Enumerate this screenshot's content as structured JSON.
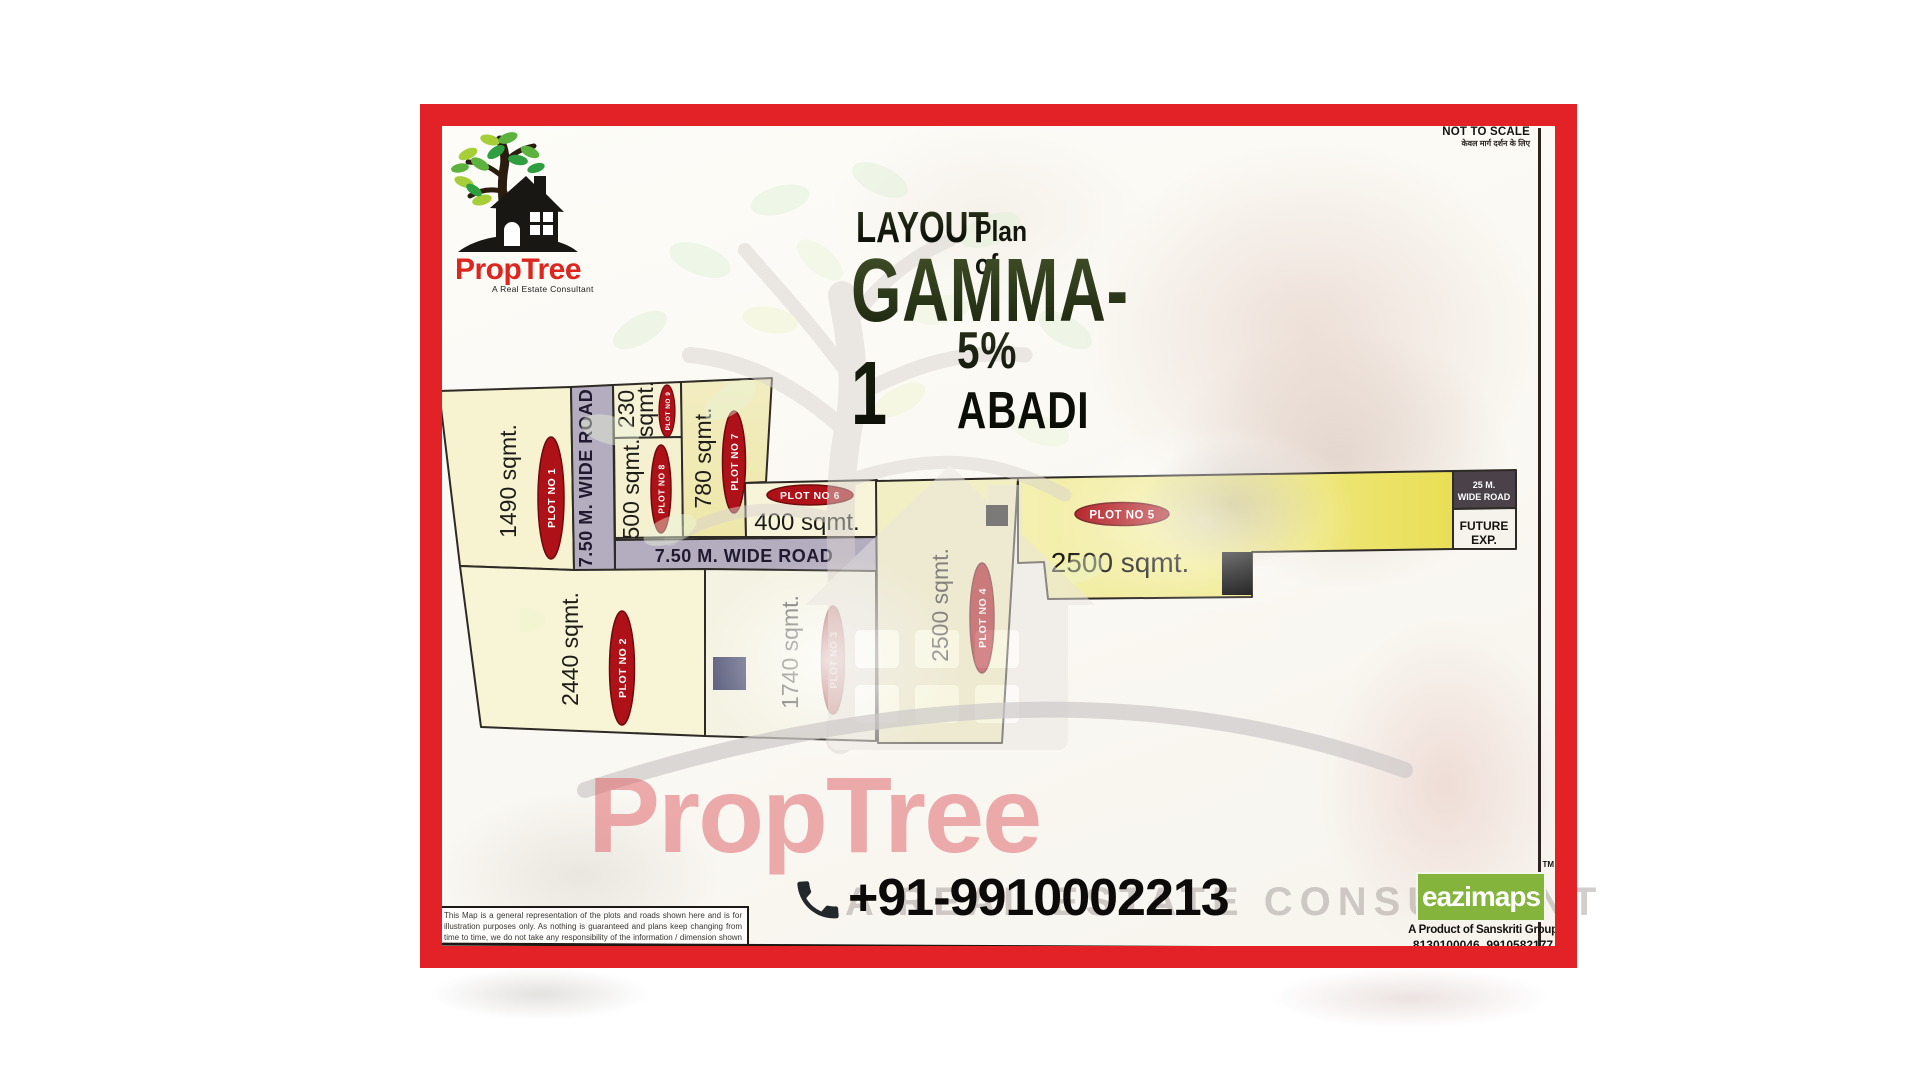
{
  "header": {
    "not_to_scale": "NOT TO SCALE",
    "not_to_scale_sub": "केवल मार्ग दर्शन के लिए"
  },
  "logo": {
    "brand": "PropTree",
    "tagline": "A Real Estate Consultant"
  },
  "title": {
    "prefix": "LAYOUT",
    "prefix_sub": "Plan of",
    "name": "GAMMA-1",
    "subtitle": "5% ABADI"
  },
  "map": {
    "roads": {
      "vertical": "7.50 M. WIDE ROAD",
      "horizontal": "7.50 M. WIDE ROAD",
      "wide_line1": "25 M.",
      "wide_line2": "WIDE ROAD",
      "future_line1": "FUTURE",
      "future_line2": "EXP."
    },
    "plots": [
      {
        "badge": "PLOT NO 1",
        "area": "1490 sqmt."
      },
      {
        "badge": "PLOT NO 2",
        "area": "2440 sqmt."
      },
      {
        "badge": "PLOT NO 3",
        "area": "1740 sqmt."
      },
      {
        "badge": "PLOT NO 4",
        "area": "2500 sqmt."
      },
      {
        "badge": "PLOT NO 5",
        "area": "2500 sqmt."
      },
      {
        "badge": "PLOT NO 6",
        "area": "400 sqmt."
      },
      {
        "badge": "PLOT NO 7",
        "area": "780 sqmt."
      },
      {
        "badge": "PLOT NO 8",
        "area": "500 sqmt."
      },
      {
        "badge": "PLOT NO 9",
        "area": "230 sqmt.",
        "area_lines": [
          "230",
          "sqmt."
        ]
      }
    ]
  },
  "watermark": {
    "brand": "PropTree",
    "tagline": "A Real Estate Consultant"
  },
  "contact": {
    "phone": "+91-9910002213"
  },
  "disclaimer": "This Map is a general representation of the plots and roads shown here and is for illustration purposes only. As nothing is guaranteed and plans keep changing from time to time, we do not take any responsibility of the information / dimension shown here. Hence, it is requested to kindly verify the details from the concerned authority and proceed with due diligence and decision.",
  "publisher": {
    "brand": "eazimaps",
    "tm": "TM",
    "line1": "A Product of Sanskriti Group",
    "line2": "8130100046, 9910582177"
  },
  "colors": {
    "frame_red": "#e32227",
    "plot_yellow": "#f6f2cc",
    "plot_yellow_deep": "#e9df55",
    "road_gray": "#b4acbf",
    "badge_red": "#ae1117",
    "dark_road_box": "#4a4149",
    "brand_red": "#dd2620",
    "eazimaps_green": "#85b43c"
  }
}
